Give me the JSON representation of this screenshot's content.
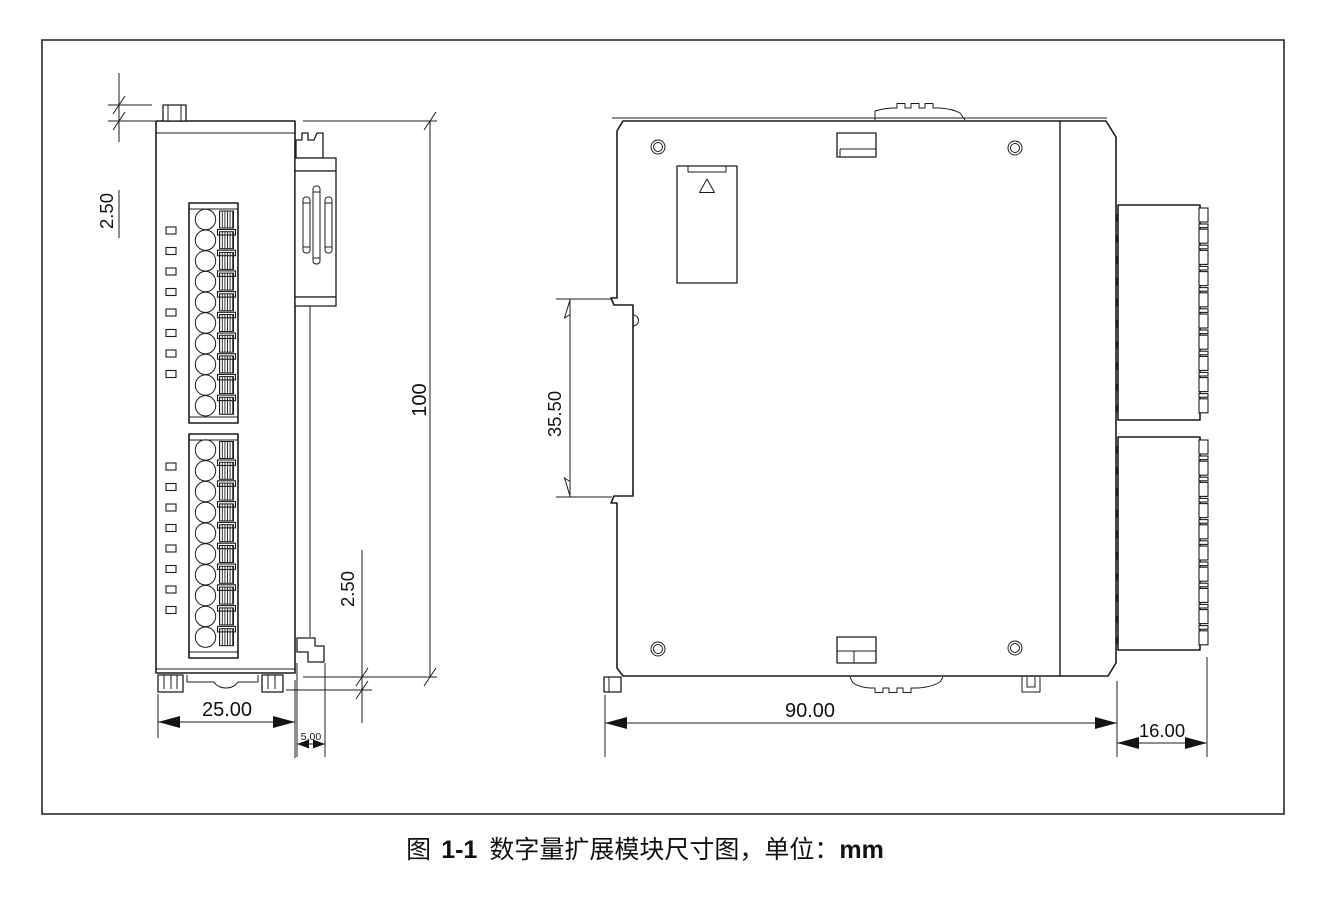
{
  "caption": {
    "figure_label": "图",
    "figure_number": "1-1",
    "title": "数字量扩展模块尺寸图，单位：",
    "unit": "mm"
  },
  "front_view": {
    "label": "front-view-of-module",
    "dims": {
      "top_clip_protrusion": "2.50",
      "height": "100",
      "bottom_clip_protrusion": "2.50",
      "width": "25.00",
      "side_hook_width": "5.00"
    },
    "terminal_blocks": [
      {
        "terminals": 10,
        "led_indicators": 8
      },
      {
        "terminals": 10,
        "led_indicators": 8
      }
    ]
  },
  "side_view": {
    "label": "side-view-of-module",
    "dims": {
      "din_rail_recess_height": "35.50",
      "depth": "90.00",
      "terminal_block_depth": "16.00"
    },
    "terminal_blocks": [
      {
        "segments": 10
      },
      {
        "segments": 10
      }
    ]
  }
}
